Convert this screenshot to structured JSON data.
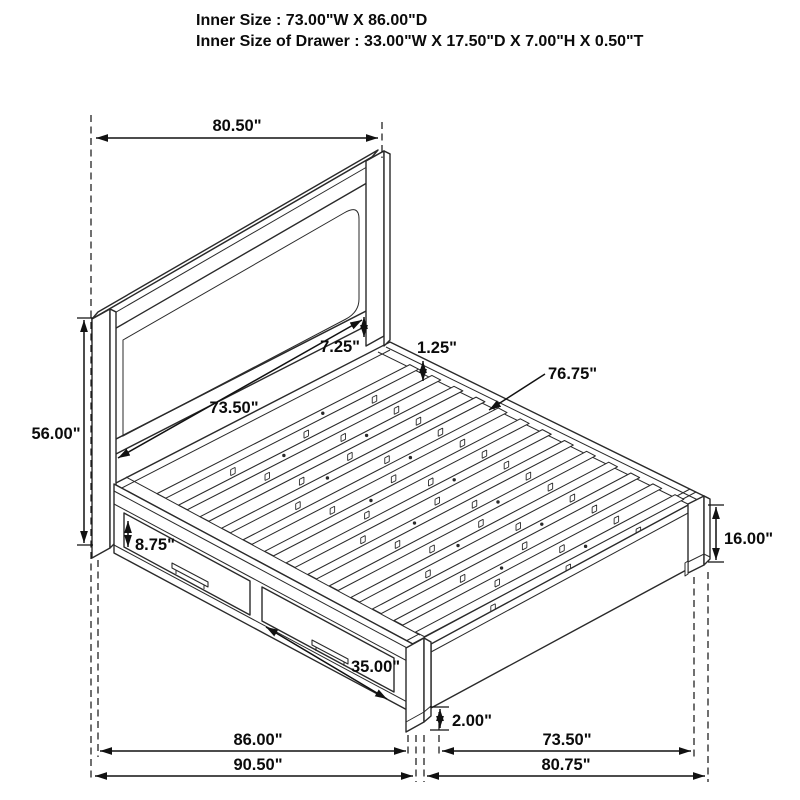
{
  "title_block": {
    "line1": "Inner Size : 73.00\"W X 86.00\"D",
    "line2": "Inner Size of Drawer : 33.00\"W X 17.50\"D X 7.00\"H X 0.50\"T"
  },
  "dimensions": {
    "headboard_width": "80.50\"",
    "headboard_height": "56.00\"",
    "panel_to_deck_gap": "7.25\"",
    "slat_thickness": "1.25\"",
    "headboard_inner_width": "73.50\"",
    "slat_length": "76.75\"",
    "drawer_front_height": "8.75\"",
    "footboard_height": "16.00\"",
    "drawer_front_width": "35.00\"",
    "base_floor_clearance": "2.00\"",
    "side_inner_length": "86.00\"",
    "side_outer_length": "90.50\"",
    "footboard_inner_width": "73.50\"",
    "footboard_outer_width": "80.75\""
  },
  "line_color": "#2a2a2a"
}
